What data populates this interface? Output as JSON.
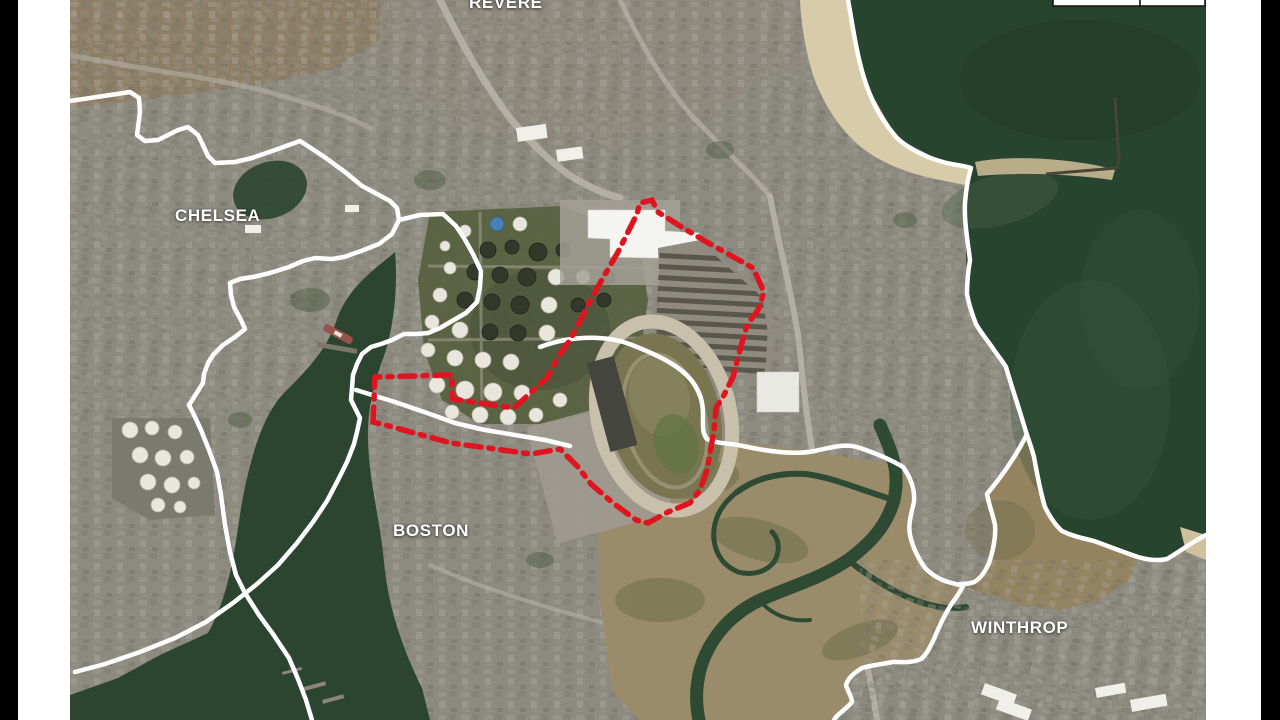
{
  "map": {
    "type": "satellite-aerial-map",
    "labels": [
      {
        "id": "revere",
        "text": "REVERE"
      },
      {
        "id": "chelsea",
        "text": "CHELSEA"
      },
      {
        "id": "boston",
        "text": "BOSTON"
      },
      {
        "id": "winthrop",
        "text": "WINTHROP"
      }
    ],
    "site_outline": {
      "color": "#e0141f",
      "style": "dash-dot"
    },
    "municipal_boundary": {
      "color": "#ffffff"
    },
    "scale_bar": {
      "segments": 2,
      "fill": "#ffffff",
      "border": "#111111"
    },
    "colors": {
      "ocean": "#27442f",
      "creek_water": "#2b4530",
      "beach_sand": "#d7cbaa",
      "marsh": "#9a8c6b",
      "urban_base": "#8d8a80",
      "racetrack_ring": "#c9c0ab",
      "letterbox": "#000000",
      "page_margin": "#ffffff",
      "label_text": "#ffffff"
    }
  }
}
